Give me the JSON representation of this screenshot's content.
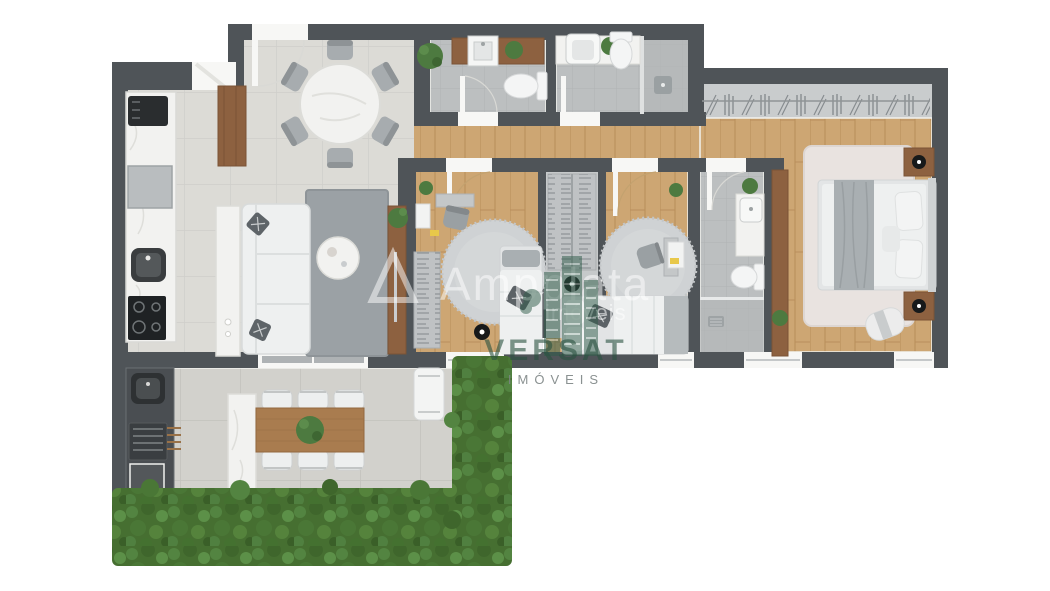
{
  "watermarks": {
    "brand": {
      "logo": "triangle-icon",
      "text": "Ampplata",
      "subtext": "imóveis"
    },
    "agency": {
      "logo": "buildings-icon",
      "name": "VERSAT",
      "subtitle": "IMÓVEIS"
    }
  },
  "palette": {
    "background": "#ffffff",
    "wall": "#4f5458",
    "tile_living": "#dcdbd6",
    "tile_terrace": "#d2d1cc",
    "tile_bath": "#bcbfc0",
    "wood_floor": "#cda673",
    "wood_furniture": "#8d6140",
    "marble": "#f2f2f0",
    "sofa_white": "#eef0f0",
    "rug_gray": "#9ba1a5",
    "hedge_green": "#466f31",
    "plant_green": "#4d7a40",
    "watermark_white": "rgba(255,255,255,0.5)",
    "versat_green": "#2f5c49",
    "imoveis_gray": "#8d9496"
  },
  "rooms": [
    {
      "id": "kitchen"
    },
    {
      "id": "dining-room"
    },
    {
      "id": "living-room"
    },
    {
      "id": "powder-room"
    },
    {
      "id": "bathroom-2"
    },
    {
      "id": "hallway"
    },
    {
      "id": "bedroom-1"
    },
    {
      "id": "walkthrough-closet"
    },
    {
      "id": "bedroom-2"
    },
    {
      "id": "bathroom-3"
    },
    {
      "id": "master-suite"
    },
    {
      "id": "gourmet-balcony"
    },
    {
      "id": "garden-hedge"
    }
  ],
  "furniture": {
    "kitchen": [
      "counter",
      "coffee-machine",
      "oven",
      "sink",
      "cooktop",
      "tall-cabinet"
    ],
    "dining_room": [
      "round-marble-table",
      "chairs-x6",
      "plant"
    ],
    "living_room": [
      "l-shaped-sofa",
      "console-table",
      "area-rug",
      "round-coffee-table",
      "tv-panel",
      "plant"
    ],
    "powder_room": [
      "wood-vanity",
      "square-sink",
      "toilet",
      "plant"
    ],
    "bathroom_2": [
      "marble-vanity",
      "sink",
      "toilet",
      "shower",
      "plant"
    ],
    "bedroom_1": [
      "open-wardrobe",
      "desk",
      "desk-chair",
      "wall-shelf",
      "round-rug",
      "single-bed",
      "floor-lamp",
      "plant"
    ],
    "walkthrough_closet": [
      "clothes-racks",
      "floor-lamp"
    ],
    "bedroom_2": [
      "round-rug",
      "single-bed",
      "desk",
      "desk-chair",
      "wall-shelf",
      "plant"
    ],
    "bathroom_3": [
      "marble-vanity",
      "sink",
      "toilet",
      "shower",
      "plant"
    ],
    "master_suite": [
      "closet-racks",
      "wardrobe-panel",
      "double-bed",
      "nightstand-x2",
      "table-lamp-x2",
      "area-rug",
      "bench",
      "plant"
    ],
    "gourmet_balcony": [
      "outdoor-sink",
      "grill",
      "counter",
      "marble-island",
      "wood-dining-table",
      "chairs-x6",
      "bench",
      "hedge-planters"
    ]
  }
}
